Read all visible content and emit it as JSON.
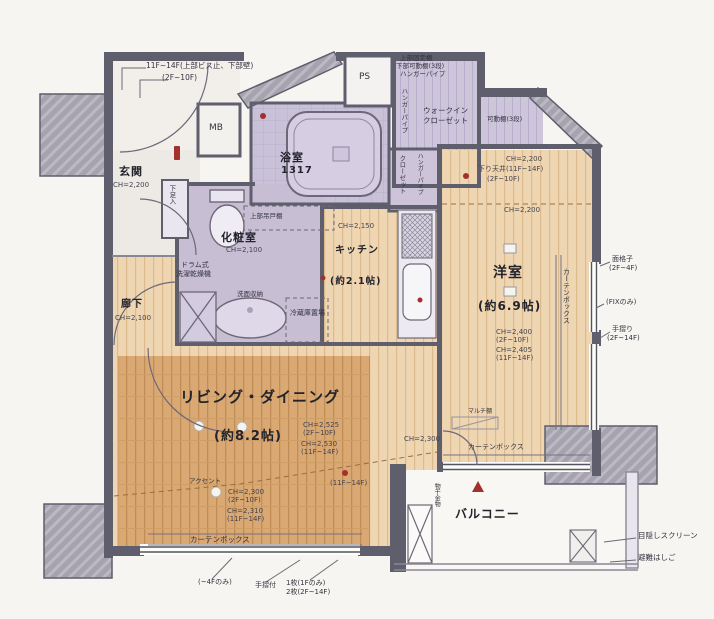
{
  "colors": {
    "wall": "#5e5e6c",
    "lavender_room": "#c9c0d6",
    "wood_light": "#efd6b2",
    "wood_dark": "#d9a873",
    "concrete": "#a6a3af",
    "marker_red": "#a32f2f",
    "balcony_floor": "#f8f7f3"
  },
  "labels": {
    "callout_top1": "11F~14F(上部ビス止、下部壁)",
    "callout_top2": "(2F~10F)",
    "mb": "MB",
    "ps": "PS",
    "bath_name": "浴室",
    "bath_size": "1317",
    "wic_note1": "上部固定棚",
    "wic_note2": "下部可動棚(3段)",
    "wic_note3": "ハンガーパイプ",
    "wic_hanger": "ハンガーパイプ",
    "wic_name1": "ウォークイン",
    "wic_name2": "クローゼット",
    "shelf_right": "可動棚(3段)",
    "closet_hanger": "ハンガーパイプ",
    "closet_name": "クローゼット",
    "genkan_name": "玄関",
    "genkan_ch": "CH=2,200",
    "shoe": "下足入",
    "powder_name": "化粧室",
    "powder_ch": "CH=2,100",
    "upper_cabinet": "上部吊戸棚",
    "washer1": "ドラム式",
    "washer2": "洗濯乾燥機",
    "vanity": "洗面収納",
    "kitchen_name": "キッチン",
    "kitchen_size": "(約2.1帖)",
    "kitchen_ch": "CH=2,150",
    "fridge": "冷蔵庫置場",
    "western_name": "洋室",
    "western_size": "(約6.9帖)",
    "western_ch1": "CH=2,200",
    "western_drop1": "下り天井(11F~14F)",
    "western_drop2": "(2F~10F)",
    "western_ch2": "CH=2,200",
    "western_ch3": "CH=2,400",
    "western_ch3f": "(2F~10F)",
    "western_ch4": "CH=2,405",
    "western_ch4f": "(11F~14F)",
    "curtain_right": "カーテンボックス",
    "hall_name": "廊下",
    "hall_ch": "CH=2,100",
    "ld_name": "リビング・ダイニング",
    "ld_size": "(約8.2帖)",
    "ld_ch1": "CH=2,525",
    "ld_ch1f": "(2F~10F)",
    "ld_ch2": "CH=2,530",
    "ld_ch2f": "(11F~14F)",
    "ld_floor_note": "(11F~14F)",
    "accent": "アクセント",
    "ld_ch3": "CH=2,300",
    "ld_ch3f": "(2F~10F)",
    "ld_ch4": "CH=2,310",
    "ld_ch4f": "(11F~14F)",
    "ld_ch5": "CH=2,300",
    "multi": "マルチ棚",
    "curtain_bottom": "カーテンボックス",
    "curtain_west": "カーテンボックス",
    "balcony_name": "バルコニー",
    "laundry": "物干金物",
    "rc1a": "面格子",
    "rc1b": "(2F~4F)",
    "rc2": "(FIXのみ)",
    "rc3a": "手摺り",
    "rc3b": "(2F~14F)",
    "rc4": "目隠しスクリーン",
    "rc5": "避難はしご",
    "bc1": "(~4Fのみ)",
    "bc2": "手摺付",
    "bc3a": "1枚(1Fのみ)",
    "bc3b": "2枚(2F~14F)"
  }
}
